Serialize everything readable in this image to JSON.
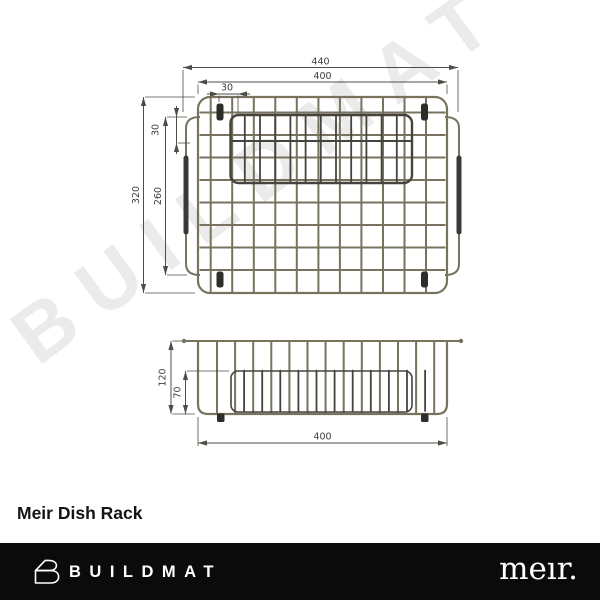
{
  "watermark": "BUILDMAT",
  "product": {
    "title": "Meir Dish Rack"
  },
  "drawing": {
    "top_view": {
      "dim_width_overall": "440",
      "dim_width_inner": "400",
      "dim_offset_top": "30",
      "dim_height_overall": "320",
      "dim_height_inner": "260",
      "dim_offset_side": "30"
    },
    "side_view": {
      "dim_height_overall": "120",
      "dim_height_inner": "70",
      "dim_width_base": "400"
    }
  },
  "footer": {
    "buildmat_logo_text": "BUILDMAT",
    "meir_logo_text": "meır.",
    "bar_color": "#0b0b0b"
  },
  "colors": {
    "wire": "#77735f",
    "dark_wire": "#45443c",
    "dimension_line": "#4f4d45",
    "watermark": "#ebebeb"
  }
}
